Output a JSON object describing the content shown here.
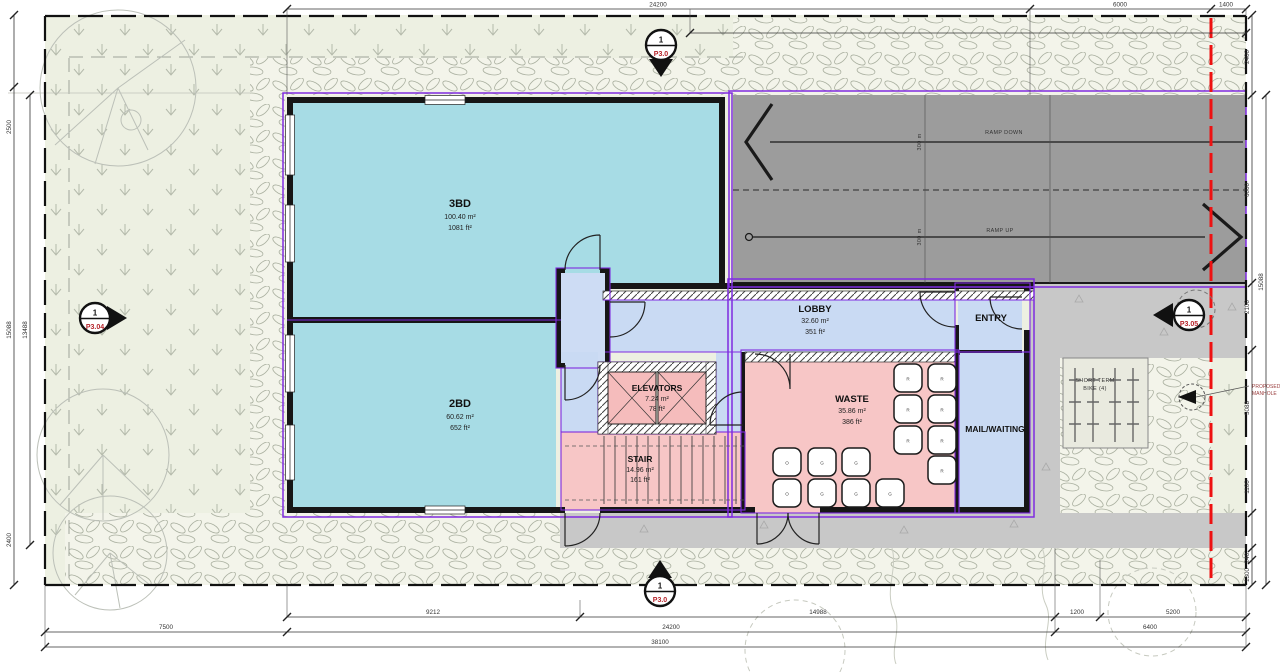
{
  "plan": {
    "rooms": {
      "bd3": {
        "name": "3BD",
        "area_m2": "100.40 m²",
        "area_ft2": "1081 ft²"
      },
      "bd2": {
        "name": "2BD",
        "area_m2": "60.62 m²",
        "area_ft2": "652 ft²"
      },
      "lobby": {
        "name": "LOBBY",
        "area_m2": "32.60 m²",
        "area_ft2": "351 ft²"
      },
      "elevators": {
        "name": "ELEVATORS",
        "area_m2": "7.24 m²",
        "area_ft2": "78 ft²"
      },
      "stair": {
        "name": "STAIR",
        "area_m2": "14.96 m²",
        "area_ft2": "161 ft²"
      },
      "waste": {
        "name": "WASTE",
        "area_m2": "35.86 m²",
        "area_ft2": "386 ft²"
      },
      "entry": {
        "name": "ENTRY"
      },
      "mail": {
        "name": "MAIL/WAITING"
      }
    },
    "ramp": {
      "down": "RAMP DOWN",
      "up": "RAMP UP",
      "len1": "300 m",
      "len2": "300 m"
    },
    "bike": {
      "line1": "SHORT TERM",
      "line2": "BIKE (4)"
    },
    "manhole": {
      "line1": "PROPOSED",
      "line2": "MANHOLE"
    },
    "bins": [
      "R",
      "R",
      "R",
      "R",
      "R",
      "R",
      "R",
      "O",
      "G",
      "G",
      "O",
      "G",
      "G",
      "G"
    ],
    "markers": {
      "top": {
        "number": "1",
        "sheet": "P3.0"
      },
      "bottom": {
        "number": "1",
        "sheet": "P3.0"
      },
      "left": {
        "number": "1",
        "sheet": "P3.04"
      },
      "right": {
        "number": "1",
        "sheet": "P3.05"
      }
    },
    "dims": {
      "top": [
        "24200",
        "6000",
        "1400"
      ],
      "bottom1": [
        "9212",
        "14988",
        "1200",
        "5200"
      ],
      "bottom2": [
        "7500",
        "24200",
        "6400"
      ],
      "bottom3": [
        "38100"
      ],
      "left": [
        "2500",
        "15088",
        "13488",
        "2400"
      ],
      "right": [
        "2400",
        "6000",
        "2100",
        "5088",
        "1100",
        "240",
        "1300"
      ],
      "right_outer": [
        "15088"
      ]
    },
    "colors": {
      "unit": "#a7dce5",
      "common": "#c9daf3",
      "service": "#f7c6c6",
      "ramp": "#9c9c9c",
      "drive": "#c8c8c8",
      "site": "#edf0e2",
      "outline": "#7f2be0",
      "property_line": "#ee1111"
    }
  }
}
